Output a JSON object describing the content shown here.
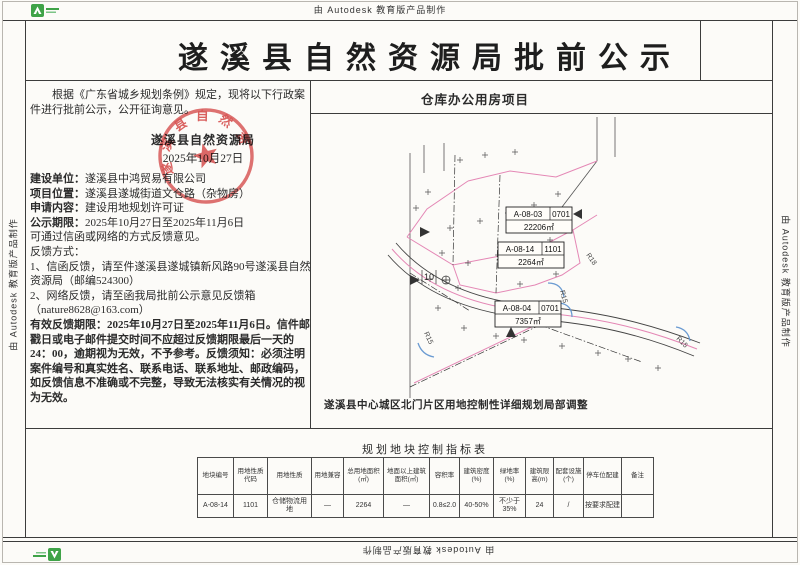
{
  "watermark": {
    "text": "由 Autodesk 教育版产品制作"
  },
  "title": "遂溪县自然资源局批前公示",
  "notice": {
    "intro": "根据《广东省城乡规划条例》规定，现将以下行政案件进行批前公示，公开征询意见。",
    "agency": "遂溪县自然资源局",
    "date": "2025年10月27日",
    "seal_text": "遂溪县自然资源局",
    "fields": [
      {
        "label": "建设单位：",
        "value": "遂溪县中鸿贸易有限公司"
      },
      {
        "label": "项目位置：",
        "value": "遂溪县遂城街道文仓路（杂物房）"
      },
      {
        "label": "申请内容：",
        "value": "建设用地规划许可证"
      },
      {
        "label": "公示期限：",
        "value": "2025年10月27日至2025年11月6日"
      }
    ],
    "lines": [
      "可通过信函或网络的方式反馈意见。",
      "反馈方式：",
      "1、信函反馈，请至件遂溪县遂城镇新风路90号遂溪县自然资源局（邮编524300）",
      "2、网络反馈，请至函我局批前公示意见反馈箱（nature8628@163.com）"
    ],
    "deadline_note": "有效反馈期限：2025年10月27日至2025年11月6日。信件邮戳日或电子邮件提交时间不应超过反馈期限最后一天的24：00，逾期视为无效，不予参考。反馈须知：必须注明案件编号和真实姓名、联系电话、联系地址、邮政编码，如反馈信息不准确或不完整，导致无法核实有关情况的视为无效。"
  },
  "project": {
    "name": "仓库办公用房项目",
    "plan_caption": "遂溪县中心城区北门片区用地控制性详细规划局部调整",
    "parcels": [
      {
        "code": "A-08-03",
        "subcode": "0701",
        "area": "22206㎡"
      },
      {
        "code": "A-08-14",
        "subcode": "1101",
        "area": "2264㎡"
      },
      {
        "code": "A-08-04",
        "subcode": "0701",
        "area": "7357㎡"
      }
    ],
    "dim_label": "10",
    "radius_labels": [
      "R18",
      "R15",
      "R15",
      "R15"
    ]
  },
  "table": {
    "title": "规划地块控制指标表",
    "headers": [
      "地块编号",
      "用地性质代码",
      "用地性质",
      "用地兼容",
      "总用地面积(㎡)",
      "地面以上建筑面积(㎡)",
      "容积率",
      "建筑密度(%)",
      "绿地率(%)",
      "建筑限高(m)",
      "配套设施(个)",
      "停车位配建",
      "备注"
    ],
    "row": [
      "A-08-14",
      "1101",
      "仓储物流用地",
      "—",
      "2264",
      "—",
      "0.8≤2.0",
      "40-50%",
      "不少于35%",
      "24",
      "/",
      "按要求配建",
      ""
    ]
  },
  "colors": {
    "seal_red": "#d43c3c",
    "parcel_pink": "#e487b5",
    "corner_blue": "#6b9bd2",
    "logo_green": "#3fa348"
  }
}
